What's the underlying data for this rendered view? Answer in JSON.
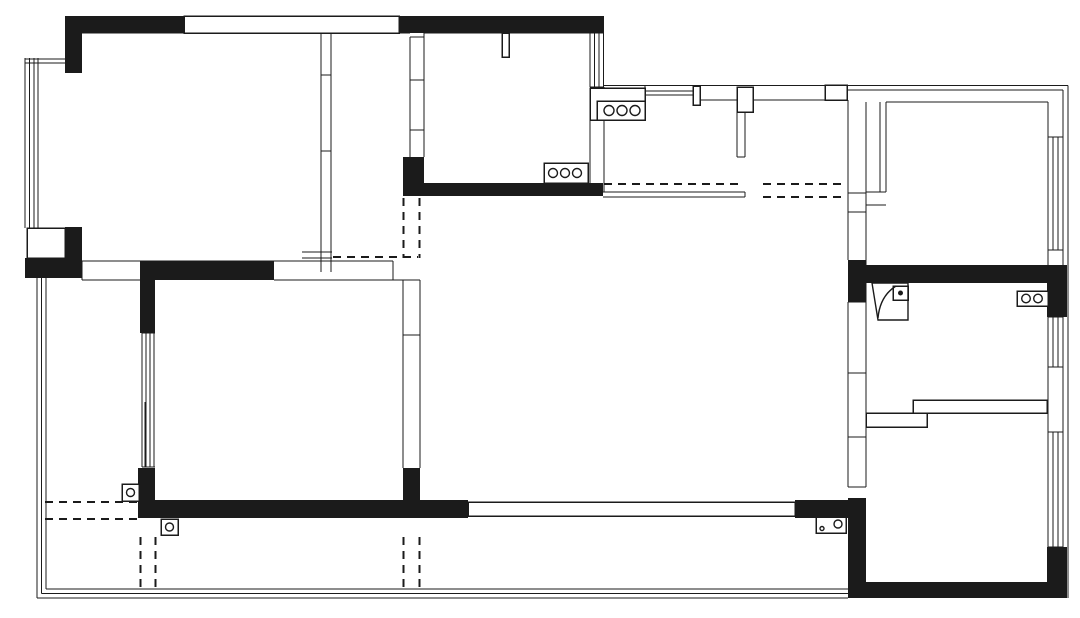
{
  "document": {
    "type": "architectural-floor-plan",
    "title": "apartment-floor-plan",
    "visible_text": []
  },
  "canvas": {
    "width": 1080,
    "height": 618,
    "background_color": "#ffffff",
    "ink_color": "#1b1b1b"
  },
  "legend": {
    "black-fill": "structural load-bearing wall",
    "double-line": "partition wall",
    "multi-line-band": "window",
    "dashed-line": "overhead / opening projection line",
    "three-circle-counter-icon": "cooktop-burners",
    "two-circle-counter-icon": "washing-machine",
    "square-with-dot-icon": "floor-drain",
    "square-with-circle-icon": "drain-pipe",
    "arc-panel-icon": "door-swing",
    "long-split-band-icon": "sliding-door"
  },
  "plan": {
    "stroke_width_line": 1.4,
    "stroke_width_box": 1.5,
    "dash_pattern": "8 6",
    "black_walls": [
      [
        65,
        16,
        119,
        17
      ],
      [
        399,
        16,
        205,
        17
      ],
      [
        65,
        16,
        17,
        57
      ],
      [
        65,
        227,
        17,
        51
      ],
      [
        25,
        258,
        57,
        20
      ],
      [
        140,
        261,
        134,
        19
      ],
      [
        140,
        261,
        15,
        72
      ],
      [
        138,
        468,
        17,
        50
      ],
      [
        138,
        500,
        330,
        18
      ],
      [
        403,
        468,
        17,
        50
      ],
      [
        403,
        157,
        21,
        39
      ],
      [
        403,
        183,
        200,
        13
      ],
      [
        795,
        500,
        55,
        18
      ],
      [
        848,
        260,
        18,
        42
      ],
      [
        848,
        265,
        219,
        18
      ],
      [
        1047,
        265,
        20,
        52
      ],
      [
        848,
        498,
        18,
        100
      ],
      [
        848,
        582,
        219,
        16
      ],
      [
        1047,
        547,
        20,
        51
      ]
    ],
    "outlined_boxes": [
      [
        184,
        16,
        215,
        17,
        "window-band"
      ],
      [
        27,
        228,
        38,
        30,
        "bay-window-sill"
      ],
      [
        502,
        33,
        7,
        24,
        "wall-stub"
      ],
      [
        544,
        163,
        44,
        20,
        "stove-counter"
      ],
      [
        590,
        88,
        55,
        32,
        "counter"
      ],
      [
        597,
        101,
        48,
        19,
        "sink-counter"
      ],
      [
        693,
        86,
        7,
        19,
        "wall-pier"
      ],
      [
        825,
        85,
        22,
        15,
        "wall-pier"
      ],
      [
        737,
        87,
        16,
        25,
        "wall-pier"
      ],
      [
        866,
        413,
        61,
        14,
        "bath-wall-step"
      ],
      [
        913,
        400,
        134,
        13,
        "bath-wall-step"
      ],
      [
        893,
        286,
        15,
        14,
        "floor-drain"
      ],
      [
        1017,
        291,
        31,
        15,
        "washing-machine"
      ],
      [
        122,
        484,
        17,
        17,
        "drain-pipe"
      ],
      [
        161,
        519,
        17,
        16,
        "drain-pipe"
      ],
      [
        816,
        517,
        30,
        16,
        "outlet-panel"
      ],
      [
        468,
        502,
        327,
        14,
        "sliding-door"
      ]
    ],
    "wall_lines": [
      [
        82,
        33,
        321,
        33
      ],
      [
        331,
        33,
        410,
        33
      ],
      [
        424,
        33,
        590,
        33
      ],
      [
        590,
        33,
        604,
        33
      ],
      [
        604,
        85.5,
        1068,
        85.5
      ],
      [
        847,
        90,
        1063,
        90
      ],
      [
        1063,
        90,
        1063,
        582
      ],
      [
        1068,
        85.5,
        1068,
        598
      ],
      [
        25,
        58,
        25,
        228
      ],
      [
        29.5,
        58,
        29.5,
        228
      ],
      [
        34,
        58,
        34,
        228
      ],
      [
        38,
        58,
        38,
        228
      ],
      [
        25,
        59,
        81,
        59
      ],
      [
        25,
        63,
        81,
        63
      ],
      [
        321,
        33,
        321,
        272
      ],
      [
        331,
        33,
        331,
        272
      ],
      [
        321,
        75,
        331,
        75
      ],
      [
        321,
        151,
        331,
        151
      ],
      [
        302,
        252,
        332,
        252
      ],
      [
        302,
        258,
        332,
        258
      ],
      [
        82,
        261,
        393,
        261
      ],
      [
        82,
        280,
        140,
        280
      ],
      [
        274,
        280,
        393,
        280
      ],
      [
        82,
        261,
        82,
        280
      ],
      [
        393,
        261,
        393,
        280
      ],
      [
        393,
        280,
        420,
        280
      ],
      [
        410,
        37,
        410,
        157
      ],
      [
        424,
        33,
        424,
        157
      ],
      [
        410,
        37,
        424,
        37
      ],
      [
        410,
        80,
        424,
        80
      ],
      [
        410,
        130,
        424,
        130
      ],
      [
        590,
        33,
        590,
        87
      ],
      [
        594.5,
        33,
        594.5,
        87
      ],
      [
        599,
        33,
        599,
        87
      ],
      [
        603.5,
        33,
        603.5,
        87
      ],
      [
        590,
        87,
        604,
        87
      ],
      [
        590,
        120,
        590,
        183
      ],
      [
        604,
        87,
        604,
        192
      ],
      [
        645,
        91,
        693,
        91
      ],
      [
        645,
        95,
        693,
        95
      ],
      [
        645,
        86,
        645,
        100
      ],
      [
        700,
        100,
        737,
        100
      ],
      [
        753,
        100,
        825,
        100
      ],
      [
        737,
        112,
        737,
        157
      ],
      [
        745,
        112,
        745,
        157
      ],
      [
        737,
        157,
        745,
        157
      ],
      [
        603,
        192,
        745,
        192
      ],
      [
        603,
        197,
        745,
        197
      ],
      [
        745,
        192,
        745,
        197
      ],
      [
        848,
        100,
        848,
        260
      ],
      [
        866,
        102,
        866,
        265
      ],
      [
        848,
        193,
        866,
        193
      ],
      [
        848,
        212,
        866,
        212
      ],
      [
        880,
        102,
        880,
        192
      ],
      [
        886,
        102,
        886,
        192
      ],
      [
        866,
        192,
        886,
        192
      ],
      [
        866,
        205,
        886,
        205
      ],
      [
        886,
        102,
        1048,
        102
      ],
      [
        1048,
        102,
        1048,
        137
      ],
      [
        1048,
        137,
        1063,
        137
      ],
      [
        1048,
        250,
        1063,
        250
      ],
      [
        1048,
        250,
        1048,
        265
      ],
      [
        1048,
        137,
        1048,
        250
      ],
      [
        1053,
        137,
        1053,
        250
      ],
      [
        1058,
        137,
        1058,
        250
      ],
      [
        1048,
        317,
        1063,
        317
      ],
      [
        1048,
        317,
        1048,
        367
      ],
      [
        1053,
        317,
        1053,
        367
      ],
      [
        1058,
        317,
        1058,
        367
      ],
      [
        1048,
        367,
        1063,
        367
      ],
      [
        1048,
        367,
        1048,
        432
      ],
      [
        1048,
        432,
        1063,
        432
      ],
      [
        1048,
        432,
        1048,
        547
      ],
      [
        1053,
        432,
        1053,
        547
      ],
      [
        1058,
        432,
        1058,
        547
      ],
      [
        1048,
        547,
        1063,
        547
      ],
      [
        848,
        302,
        848,
        487
      ],
      [
        866,
        283,
        866,
        487
      ],
      [
        848,
        302,
        866,
        302
      ],
      [
        848,
        373,
        866,
        373
      ],
      [
        848,
        437,
        866,
        437
      ],
      [
        848,
        487,
        866,
        487
      ],
      [
        510,
        507,
        795,
        507
      ],
      [
        468,
        511,
        755,
        511
      ],
      [
        510,
        502,
        510,
        507
      ],
      [
        755,
        511,
        755,
        516
      ],
      [
        37,
        278,
        37,
        598
      ],
      [
        41.5,
        278,
        41.5,
        593.5
      ],
      [
        46,
        278,
        46,
        589
      ],
      [
        46,
        589,
        848,
        589
      ],
      [
        41.5,
        593.5,
        848,
        593.5
      ],
      [
        37,
        598,
        848,
        598
      ],
      [
        142,
        333,
        142,
        467
      ],
      [
        146,
        333,
        146,
        467
      ],
      [
        150,
        333,
        150,
        467
      ],
      [
        154,
        333,
        154,
        467
      ],
      [
        142,
        333,
        155,
        333
      ],
      [
        142,
        467,
        155,
        467
      ],
      [
        145,
        402,
        145,
        467
      ],
      [
        403,
        280,
        403,
        468
      ],
      [
        420,
        280,
        420,
        468
      ],
      [
        403,
        335,
        420,
        335
      ]
    ],
    "dashed_lines": [
      [
        45,
        502,
        138,
        502
      ],
      [
        45,
        519,
        138,
        519
      ],
      [
        140.5,
        537,
        140.5,
        590
      ],
      [
        155.5,
        537,
        155.5,
        590
      ],
      [
        403.5,
        537,
        403.5,
        590
      ],
      [
        419.5,
        537,
        419.5,
        590
      ],
      [
        403.5,
        198,
        403.5,
        258
      ],
      [
        419.5,
        198,
        419.5,
        258
      ],
      [
        333,
        257,
        418,
        257
      ],
      [
        604,
        184,
        740,
        184
      ],
      [
        763,
        184,
        845,
        184
      ],
      [
        763,
        197,
        845,
        197
      ]
    ],
    "fixture_circles": [
      [
        553,
        173,
        4.5,
        0,
        "burner"
      ],
      [
        565,
        173,
        4.5,
        0,
        "burner"
      ],
      [
        577,
        173,
        4.5,
        0,
        "burner"
      ],
      [
        609,
        110.5,
        5,
        0,
        "burner"
      ],
      [
        622,
        110.5,
        5,
        0,
        "burner"
      ],
      [
        635,
        110.5,
        5,
        0,
        "burner"
      ],
      [
        900.5,
        293,
        1.8,
        1,
        "drain-dot"
      ],
      [
        1026,
        298.5,
        4.3,
        0,
        "washer-drum"
      ],
      [
        1038,
        298.5,
        4.3,
        0,
        "washer-drum"
      ],
      [
        130.5,
        492.5,
        4,
        0,
        "pipe"
      ],
      [
        169.5,
        527,
        4,
        0,
        "pipe"
      ],
      [
        838,
        524,
        4,
        0,
        "pipe"
      ],
      [
        822,
        528.5,
        2,
        0,
        "pipe-small"
      ]
    ],
    "fixture_paths": [
      [
        "M 872 283 L 908 283 L 908 320 L 878 320 Z",
        "door-panel"
      ],
      [
        "M 878 318 Q 880 296 896 286",
        "door-arc"
      ]
    ]
  }
}
